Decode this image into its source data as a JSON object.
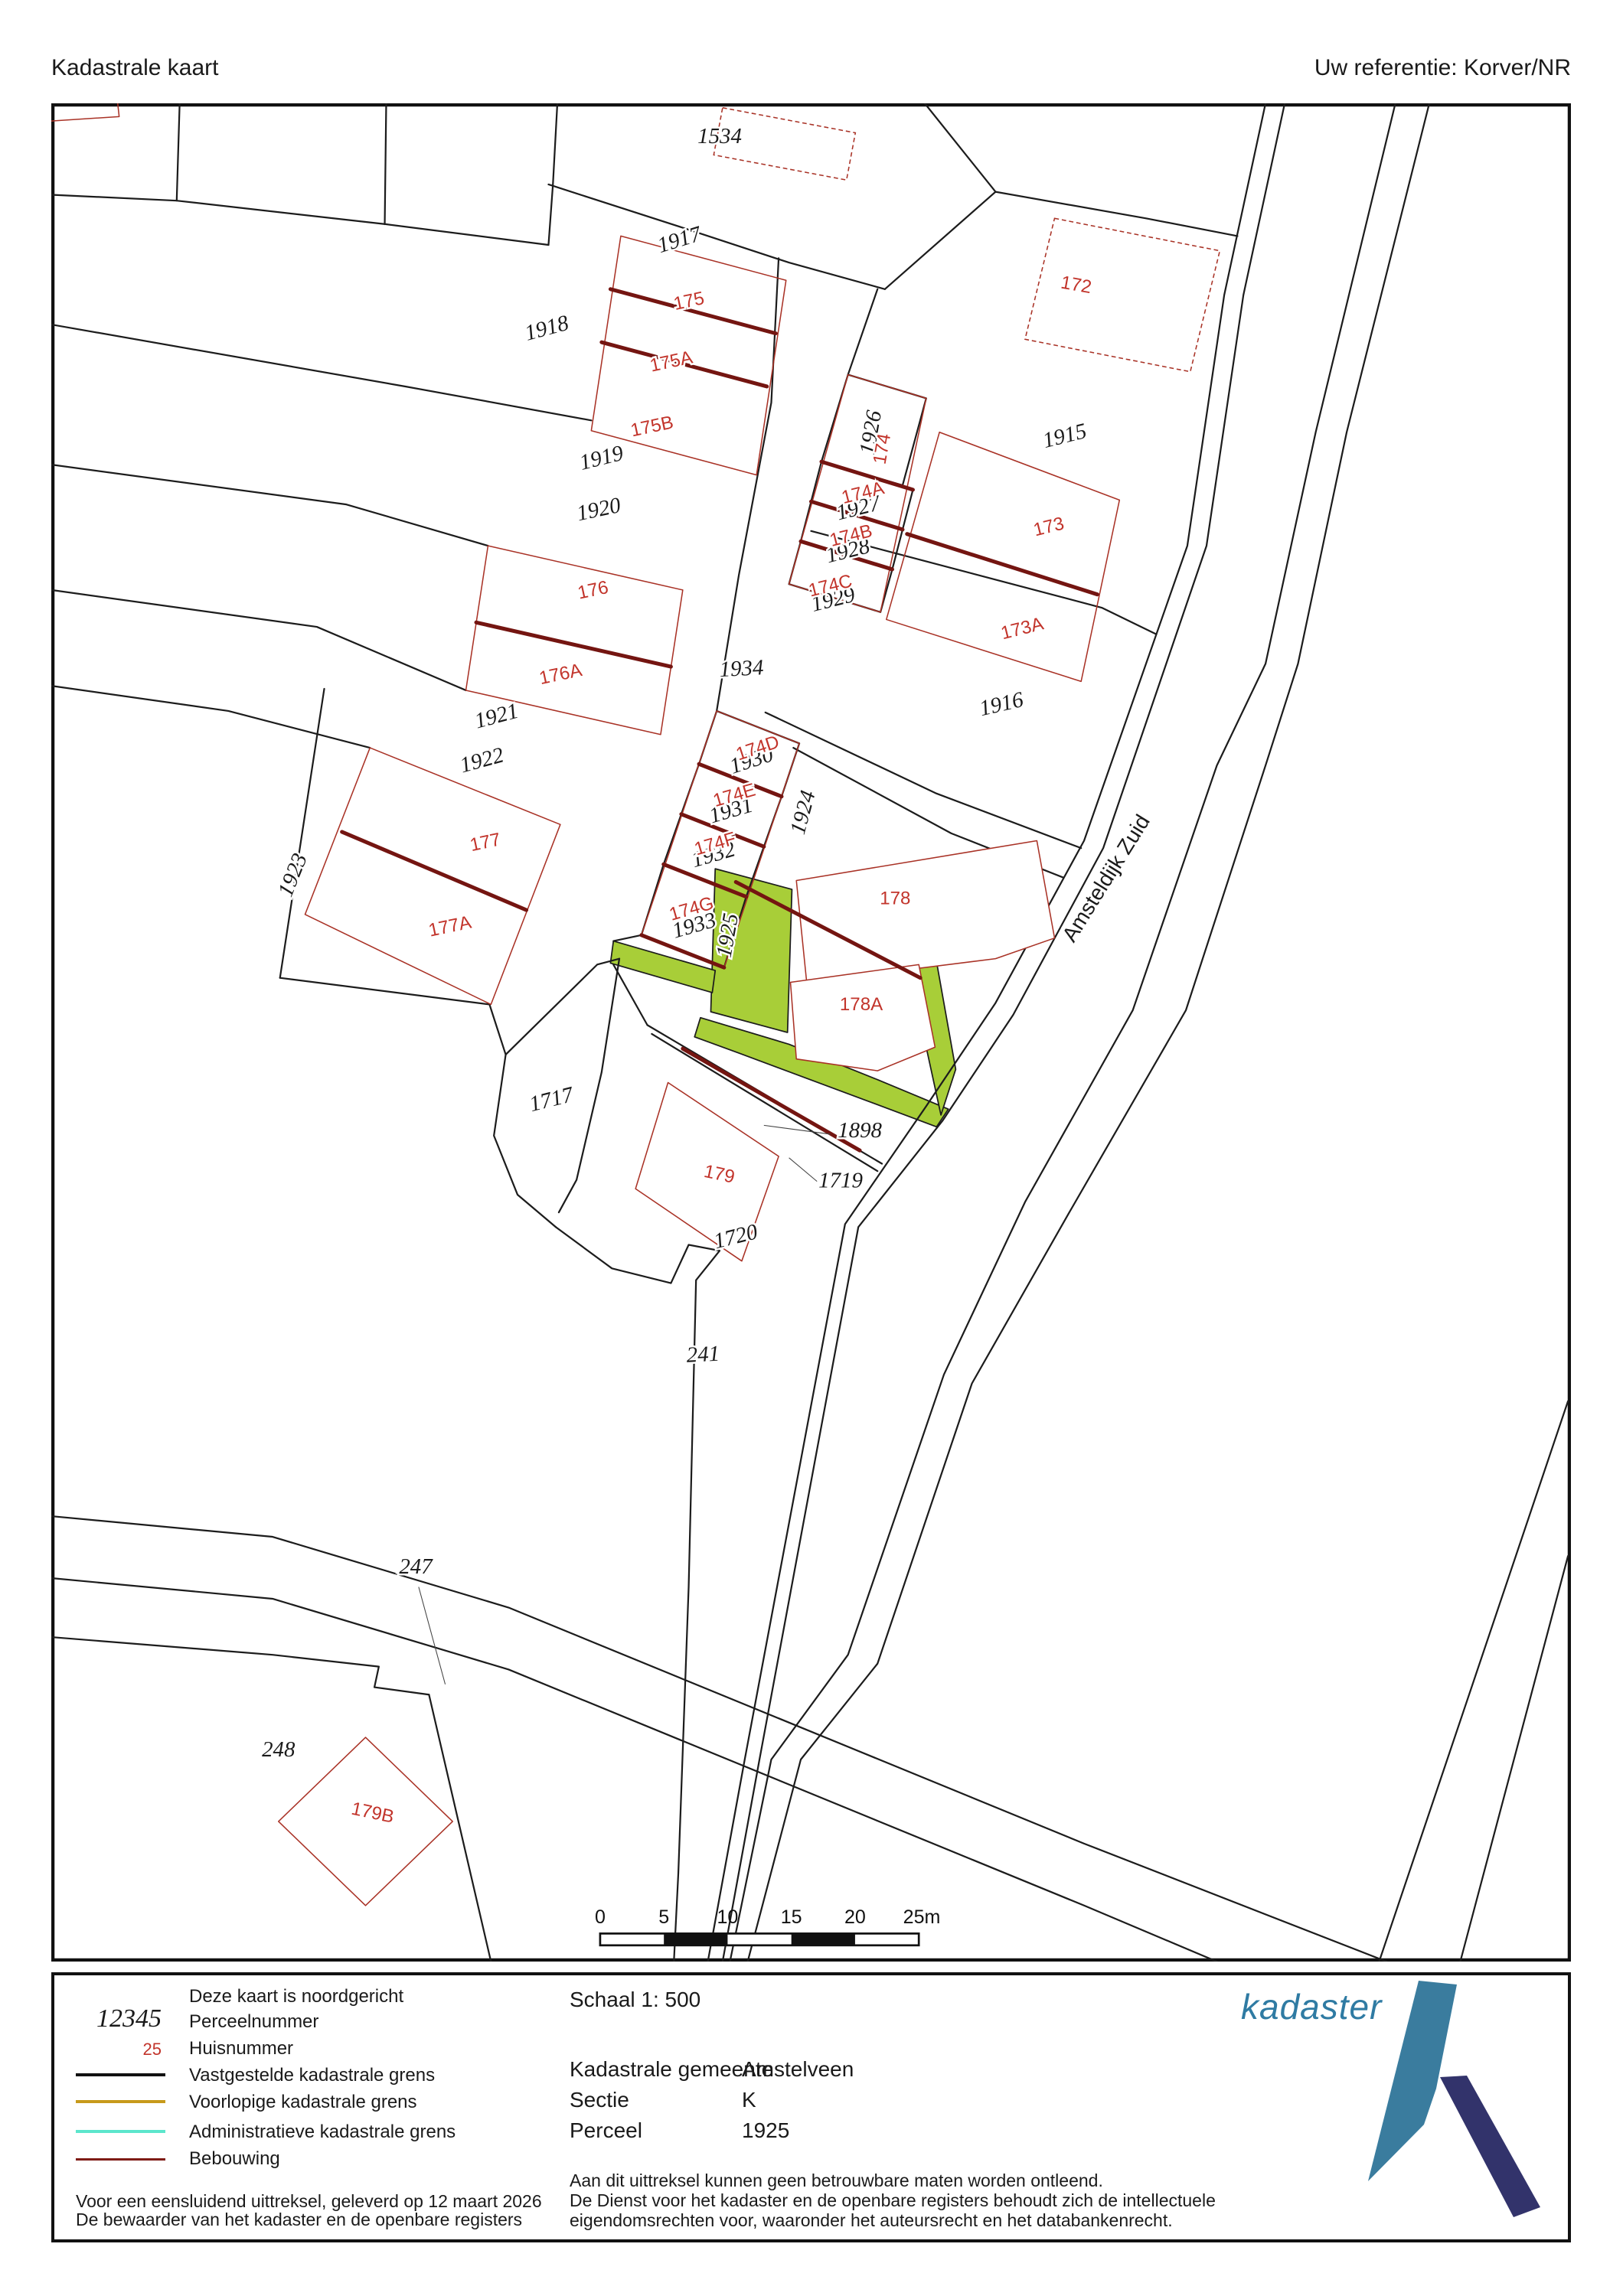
{
  "header": {
    "title": "Kadastrale kaart",
    "reference": "Uw referentie: Korver/NR"
  },
  "map": {
    "street": "Amsteldijk Zuid",
    "highlight_parcel": "1925",
    "colors": {
      "highlight_green": "#a8ce38",
      "parcel_line": "#1c1c1c",
      "building_line": "#a93226",
      "building_wall": "#741511",
      "house_number": "#c2342b"
    },
    "labels": [
      {
        "t": "1534",
        "kind": "parcel"
      },
      {
        "t": "1917",
        "kind": "parcel"
      },
      {
        "t": "1918",
        "kind": "parcel"
      },
      {
        "t": "1919",
        "kind": "parcel"
      },
      {
        "t": "1920",
        "kind": "parcel"
      },
      {
        "t": "1921",
        "kind": "parcel"
      },
      {
        "t": "1922",
        "kind": "parcel"
      },
      {
        "t": "1923",
        "kind": "parcel"
      },
      {
        "t": "1926",
        "kind": "parcel"
      },
      {
        "t": "1927",
        "kind": "parcel"
      },
      {
        "t": "1928",
        "kind": "parcel"
      },
      {
        "t": "1929",
        "kind": "parcel"
      },
      {
        "t": "1915",
        "kind": "parcel"
      },
      {
        "t": "1916",
        "kind": "parcel"
      },
      {
        "t": "1934",
        "kind": "parcel"
      },
      {
        "t": "1930",
        "kind": "parcel"
      },
      {
        "t": "1931",
        "kind": "parcel"
      },
      {
        "t": "1932",
        "kind": "parcel"
      },
      {
        "t": "1933",
        "kind": "parcel"
      },
      {
        "t": "1924",
        "kind": "parcel"
      },
      {
        "t": "1925",
        "kind": "parcel-highlight"
      },
      {
        "t": "1717",
        "kind": "parcel"
      },
      {
        "t": "1898",
        "kind": "parcel"
      },
      {
        "t": "1719",
        "kind": "parcel"
      },
      {
        "t": "1720",
        "kind": "parcel"
      },
      {
        "t": "241",
        "kind": "parcel"
      },
      {
        "t": "247",
        "kind": "parcel"
      },
      {
        "t": "248",
        "kind": "parcel"
      },
      {
        "t": "172",
        "kind": "huisnummer"
      },
      {
        "t": "173",
        "kind": "huisnummer"
      },
      {
        "t": "173A",
        "kind": "huisnummer"
      },
      {
        "t": "174",
        "kind": "huisnummer"
      },
      {
        "t": "174A",
        "kind": "huisnummer"
      },
      {
        "t": "174B",
        "kind": "huisnummer"
      },
      {
        "t": "174C",
        "kind": "huisnummer"
      },
      {
        "t": "174D",
        "kind": "huisnummer"
      },
      {
        "t": "174E",
        "kind": "huisnummer"
      },
      {
        "t": "174F",
        "kind": "huisnummer"
      },
      {
        "t": "174G",
        "kind": "huisnummer"
      },
      {
        "t": "175",
        "kind": "huisnummer"
      },
      {
        "t": "175A",
        "kind": "huisnummer"
      },
      {
        "t": "175B",
        "kind": "huisnummer"
      },
      {
        "t": "176",
        "kind": "huisnummer"
      },
      {
        "t": "176A",
        "kind": "huisnummer"
      },
      {
        "t": "177",
        "kind": "huisnummer"
      },
      {
        "t": "177A",
        "kind": "huisnummer"
      },
      {
        "t": "178",
        "kind": "huisnummer"
      },
      {
        "t": "178A",
        "kind": "huisnummer"
      },
      {
        "t": "179",
        "kind": "huisnummer"
      },
      {
        "t": "179B",
        "kind": "huisnummer"
      },
      {
        "t": "Amsteldijk Zuid",
        "kind": "street"
      }
    ]
  },
  "scalebar": {
    "ticks": [
      "0",
      "5",
      "10",
      "15",
      "20",
      "25m"
    ]
  },
  "legend": {
    "north_note": "Deze kaart is noordgericht",
    "perceel_sample": "12345",
    "perceel_label": "Perceelnummer",
    "huis_sample": "25",
    "huis_label": "Huisnummer",
    "line_items": [
      {
        "label": "Vastgestelde kadastrale grens",
        "color": "#111111"
      },
      {
        "label": "Voorlopige kadastrale grens",
        "color": "#c79a1b"
      },
      {
        "label": "Administratieve kadastrale grens",
        "color": "#5ce6cc"
      },
      {
        "label": "Bebouwing",
        "color": "#7e1b15"
      }
    ],
    "footer_line1": "Voor een eensluidend uittreksel, geleverd op 12 maart 2026",
    "footer_line2": "De bewaarder van het kadaster en de openbare registers"
  },
  "info": {
    "schaal": "Schaal 1: 500",
    "rows": [
      {
        "label": "Kadastrale gemeente",
        "value": "Amstelveen"
      },
      {
        "label": "Sectie",
        "value": "K"
      },
      {
        "label": "Perceel",
        "value": "1925"
      }
    ],
    "disclaimer1": "Aan dit uittreksel kunnen geen betrouwbare maten worden ontleend.",
    "disclaimer2": "De Dienst voor het kadaster en de openbare registers behoudt zich de intellectuele",
    "disclaimer3": "eigendomsrechten voor, waaronder het auteursrecht en het databankenrecht."
  },
  "logo": {
    "wordmark": "kadaster"
  }
}
